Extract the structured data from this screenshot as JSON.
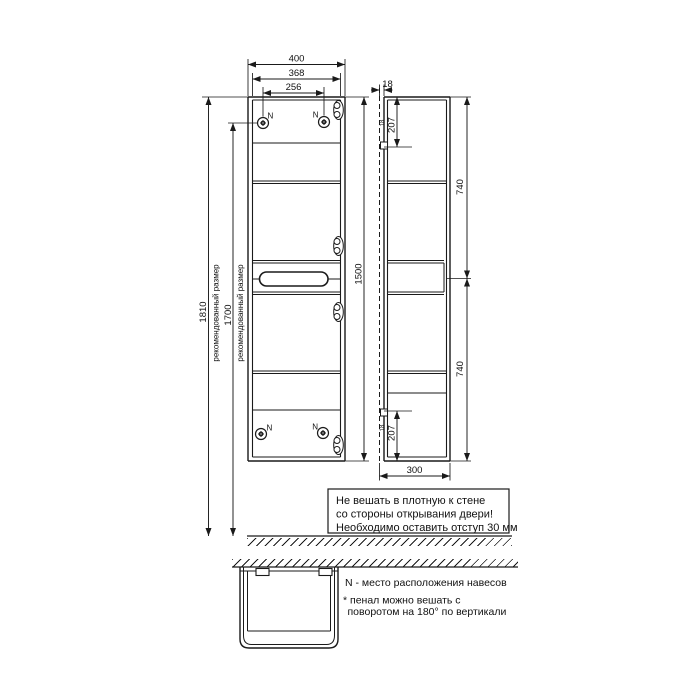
{
  "front": {
    "dim_width": "400",
    "dim_width_inner": "368",
    "dim_hanger_span": "256",
    "dim_height": "1500",
    "hanger_label": "N"
  },
  "left": {
    "dim_overall": "1810",
    "dim_overall_note": "рекомендованный размер",
    "dim_hanger_height": "1700",
    "dim_hanger_height_note": "рекомендованный размер"
  },
  "side": {
    "dim_rail_offset": "18",
    "dim_hanger_top": "207",
    "dim_hanger_top_inset": "18",
    "dim_upper_section": "740",
    "dim_lower_section": "740",
    "dim_hanger_bottom": "207",
    "dim_hanger_bottom_inset": "18",
    "dim_depth": "300"
  },
  "warning": {
    "line1": "Не вешать в плотную к стене",
    "line2": "со стороны открывания двери!",
    "line3": "Необходимо оставить отступ 30 мм"
  },
  "notes": {
    "hangers": "N - место расположения навесов",
    "rotate1": "* пенал можно вешать с",
    "rotate2": "поворотом на 180° по вертикали"
  },
  "colors": {
    "line": "#1a1a1a",
    "background": "#ffffff"
  }
}
